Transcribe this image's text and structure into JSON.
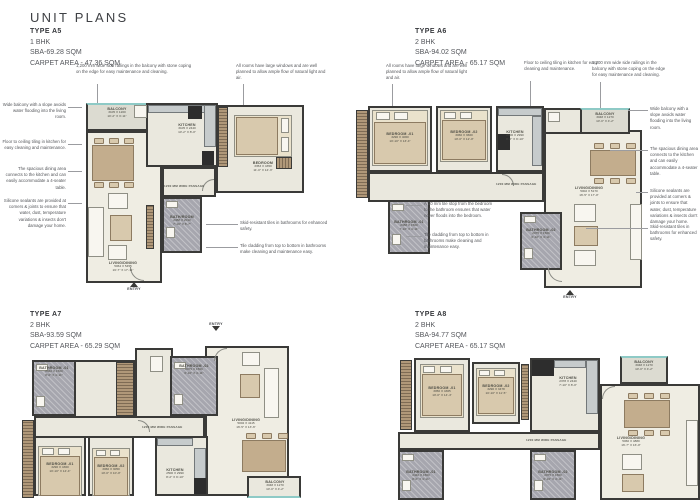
{
  "page": {
    "title": "UNIT PLANS"
  },
  "labels": {
    "entry": "ENTRY",
    "passage": "1200 MM WIDE PASSAGE"
  },
  "ann": {
    "railing": "1,200 mm wide side railings in the balcony with stone coping on the edge for easy maintenance and cleaning.",
    "windows": "All rooms have large windows and are well planned to allow ample flow of natural light and air.",
    "slope": "Wide balcony with a slope avoids water flooding into the living room.",
    "tiling": "Floor to ceiling tiling in kitchen for easy cleaning and maintenance.",
    "dining": "The spacious dining area connects to the kitchen and can easily accommodate a 4-seater table.",
    "sealants": "Silicone sealants are provided at corners & joints to ensure that water, dust, temperature variations & insects don't damage your home.",
    "skid": "Skid-resistant tiles in bathrooms for enhanced safety.",
    "cladding": "Tile cladding from top to bottom in bathrooms make cleaning and maintenance easy.",
    "tilestop": "A 10 mm tile stop from the bedroom to the bathroom ensures that water never floods into the bedroom."
  },
  "units": {
    "a5": {
      "type": "TYPE A5",
      "bhk": "1 BHK",
      "sba": "SBA-69.28 SQM",
      "carpet": "CARPET AREA - 47.36 SQM",
      "rooms": {
        "balcony": {
          "name": "BALCONY",
          "mm": "3105 X 1200",
          "ft": "10'-2\" X 3'-11\""
        },
        "kitchen": {
          "name": "KITCHEN",
          "mm": "3105 X 2440",
          "ft": "10'-2\" X 8'-0\""
        },
        "bedroom": {
          "name": "BEDROOM",
          "mm": "3353 X 4350",
          "ft": "11'-0\" X 14'-3\""
        },
        "living": {
          "name": "LIVING/DINING",
          "mm": "5064 X 5455",
          "ft": "16'-7\" X 17'-11\""
        },
        "bath": {
          "name": "BATH/ROOM",
          "mm": "2388 X 2010",
          "ft": "7'-10\" X 6'-7\""
        }
      }
    },
    "a6": {
      "type": "TYPE A6",
      "bhk": "2 BHK",
      "sba": "SBA-94.02 SQM",
      "carpet": "CARPET AREA - 65.17 SQM",
      "rooms": {
        "bedroom1": {
          "name": "BEDROOM -01",
          "mm": "3290 X 4060",
          "ft": "10'-10\" X 13'-4\""
        },
        "bedroom2": {
          "name": "BEDROOM -02",
          "mm": "3060 X 3660",
          "ft": "10'-0\" X 12'-0\""
        },
        "kitchen": {
          "name": "KITCHEN",
          "mm": "2500 X 2990",
          "ft": "8'-2\" X 9'-10\""
        },
        "balcony": {
          "name": "BALCONY",
          "mm": "3048 X 1270",
          "ft": "10'-0\" X 4'-2\""
        },
        "living": {
          "name": "LIVING/DINING",
          "mm": "5002 X 5170",
          "ft": "16'-5\" X 17'-0\""
        },
        "bath1": {
          "name": "BATHROOM -01",
          "mm": "2388 X 1500",
          "ft": "7'-10\" X 4'-11\""
        },
        "bath2": {
          "name": "BATHROOM -02",
          "mm": "2075 X 1500",
          "ft": "6'-10\" X 4'-11\""
        }
      }
    },
    "a7": {
      "type": "TYPE A7",
      "bhk": "2 BHK",
      "sba": "SBA-93.59 SQM",
      "carpet": "CARPET AREA - 65.29 SQM",
      "rooms": {
        "bath1": {
          "name": "BATHROOM -01",
          "mm": "2440 X 1500",
          "ft": "8'-0\" X 4'-11\""
        },
        "bath2": {
          "name": "BATHROOM -02",
          "mm": "2075 X 1500",
          "ft": "6'-10\" X 4'-11\""
        },
        "bedroom1": {
          "name": "BEDROOM -01",
          "mm": "3290 X 4360",
          "ft": "10'-10\" X 14'-4\""
        },
        "bedroom2": {
          "name": "BEDROOM -02",
          "mm": "3060 X 3050",
          "ft": "10'-0\" X 10'-0\""
        },
        "kitchen": {
          "name": "KITCHEN",
          "mm": "2500 X 2990",
          "ft": "8'-2\" X 9'-10\""
        },
        "living": {
          "name": "LIVING/DINING",
          "mm": "5002 X 4115",
          "ft": "16'-5\" X 13'-6\""
        },
        "balcony": {
          "name": "BALCONY",
          "mm": "3048 X 1270",
          "ft": "10'-0\" X 4'-2\""
        }
      }
    },
    "a8": {
      "type": "TYPE A8",
      "bhk": "2 BHK",
      "sba": "SBA-94.77 SQM",
      "carpet": "CARPET AREA - 65.17 SQM",
      "rooms": {
        "bedroom1": {
          "name": "BEDROOM -01",
          "mm": "3050 X 4365",
          "ft": "10'-0\" X 14'-4\""
        },
        "bedroom2": {
          "name": "BEDROOM -02",
          "mm": "3290 X 3478",
          "ft": "10'-10\" X 11'-5\""
        },
        "kitchen": {
          "name": "KITCHEN",
          "mm": "2378 X 2440",
          "ft": "7'-10\" X 8'-0\""
        },
        "balcony": {
          "name": "BALCONY",
          "mm": "3048 X 1270",
          "ft": "10'-0\" X 4'-2\""
        },
        "living": {
          "name": "LIVING/DINING",
          "mm": "5060 X 4880",
          "ft": "16'-7\" X 16'-0\""
        },
        "bath1": {
          "name": "BATHROOM -01",
          "mm": "2440 X 1500",
          "ft": "8'-0\" X 4'-11\""
        },
        "bath2": {
          "name": "BATHROOM -02",
          "mm": "2075 X 1500",
          "ft": "6'-10\" X 4'-11\""
        }
      }
    }
  }
}
